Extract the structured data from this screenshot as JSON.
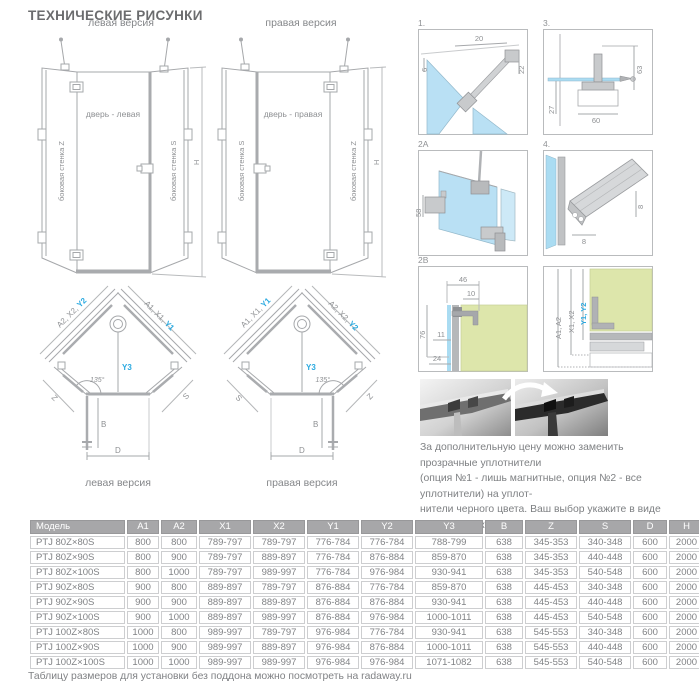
{
  "page": {
    "title": "ТЕХНИЧЕСКИЕ РИСУНКИ",
    "footer": "Таблицу размеров для установки без поддона можно посмотреть на radaway.ru"
  },
  "colors": {
    "accent_blue": "#29a9e0",
    "glass_blue": "#b9e0f4",
    "wall_green": "#dde6ab",
    "table_header_gray": "#a7a7a9"
  },
  "elevations": {
    "left": {
      "caption": "левая версия",
      "wall_left": "боковая стенка Z",
      "door": "дверь - левая",
      "wall_right": "боковая стенка S",
      "height_label": "H"
    },
    "right": {
      "caption": "правая версия",
      "wall_left": "боковая стенка S",
      "door": "дверь - правая",
      "wall_right": "боковая стенка Z",
      "height_label": "H"
    }
  },
  "plans": {
    "left": {
      "caption": "левая версия",
      "diag_left_gray": "A2, X2, ",
      "diag_left_blue": "Y2",
      "diag_right_gray": "A1, X1, ",
      "diag_right_blue": "Y1",
      "center_label": "Y3",
      "angle": "135°",
      "side_left": "Z",
      "side_right": "S",
      "dim_b": "B",
      "dim_d": "D"
    },
    "right": {
      "caption": "правая версия",
      "diag_left_gray": "A1, X1, ",
      "diag_left_blue": "Y1",
      "diag_right_gray": "A2, X2, ",
      "diag_right_blue": "Y2",
      "center_label": "Y3",
      "angle": "135°",
      "side_left": "S",
      "side_right": "Z",
      "dim_b": "B",
      "dim_d": "D"
    }
  },
  "details": {
    "d1": {
      "label": "1.",
      "dim_top": "20",
      "dim_left": "6",
      "dim_right": "22"
    },
    "d3": {
      "label": "3.",
      "dim_right": "63",
      "dim_left": "27",
      "dim_bottom": "60"
    },
    "d2a": {
      "label": "2A",
      "dim_left": "58"
    },
    "d4": {
      "label": "4.",
      "dim_bottom": "8",
      "dim_right": "8"
    },
    "d2b": {
      "label": "2B",
      "dim_46": "46",
      "dim_10": "10",
      "dim_76": "76",
      "dim_11": "11",
      "dim_24": "24"
    },
    "d6": {
      "dim_a": "A1, A2",
      "dim_x": "X1, X2",
      "dim_y": "Y1, Y2"
    }
  },
  "note": {
    "line1": "За дополнительную цену можно заменить прозрачные уплотнители",
    "line2": "(опция №1 - лишь магнитные, опция №2 - все уплотнители) на уплот-",
    "line3": "нители черного цвета. Ваш выбор укажите в виде пометки к заказу."
  },
  "table": {
    "headers": [
      "Модель",
      "A1",
      "A2",
      "X1",
      "X2",
      "Y1",
      "Y2",
      "Y3",
      "B",
      "Z",
      "S",
      "D",
      "H"
    ],
    "rows": [
      [
        "PTJ 80Z×80S",
        "800",
        "800",
        "789-797",
        "789-797",
        "776-784",
        "776-784",
        "788-799",
        "638",
        "345-353",
        "340-348",
        "600",
        "2000"
      ],
      [
        "PTJ 80Z×90S",
        "800",
        "900",
        "789-797",
        "889-897",
        "776-784",
        "876-884",
        "859-870",
        "638",
        "345-353",
        "440-448",
        "600",
        "2000"
      ],
      [
        "PTJ 80Z×100S",
        "800",
        "1000",
        "789-797",
        "989-997",
        "776-784",
        "976-984",
        "930-941",
        "638",
        "345-353",
        "540-548",
        "600",
        "2000"
      ],
      [
        "PTJ 90Z×80S",
        "900",
        "800",
        "889-897",
        "789-797",
        "876-884",
        "776-784",
        "859-870",
        "638",
        "445-453",
        "340-348",
        "600",
        "2000"
      ],
      [
        "PTJ 90Z×90S",
        "900",
        "900",
        "889-897",
        "889-897",
        "876-884",
        "876-884",
        "930-941",
        "638",
        "445-453",
        "440-448",
        "600",
        "2000"
      ],
      [
        "PTJ 90Z×100S",
        "900",
        "1000",
        "889-897",
        "989-997",
        "876-884",
        "976-984",
        "1000-1011",
        "638",
        "445-453",
        "540-548",
        "600",
        "2000"
      ],
      [
        "PTJ 100Z×80S",
        "1000",
        "800",
        "989-997",
        "789-797",
        "976-984",
        "776-784",
        "930-941",
        "638",
        "545-553",
        "340-348",
        "600",
        "2000"
      ],
      [
        "PTJ 100Z×90S",
        "1000",
        "900",
        "989-997",
        "889-897",
        "976-984",
        "876-884",
        "1000-1011",
        "638",
        "545-553",
        "440-448",
        "600",
        "2000"
      ],
      [
        "PTJ 100Z×100S",
        "1000",
        "1000",
        "989-997",
        "989-997",
        "976-984",
        "976-984",
        "1071-1082",
        "638",
        "545-553",
        "540-548",
        "600",
        "2000"
      ]
    ]
  }
}
